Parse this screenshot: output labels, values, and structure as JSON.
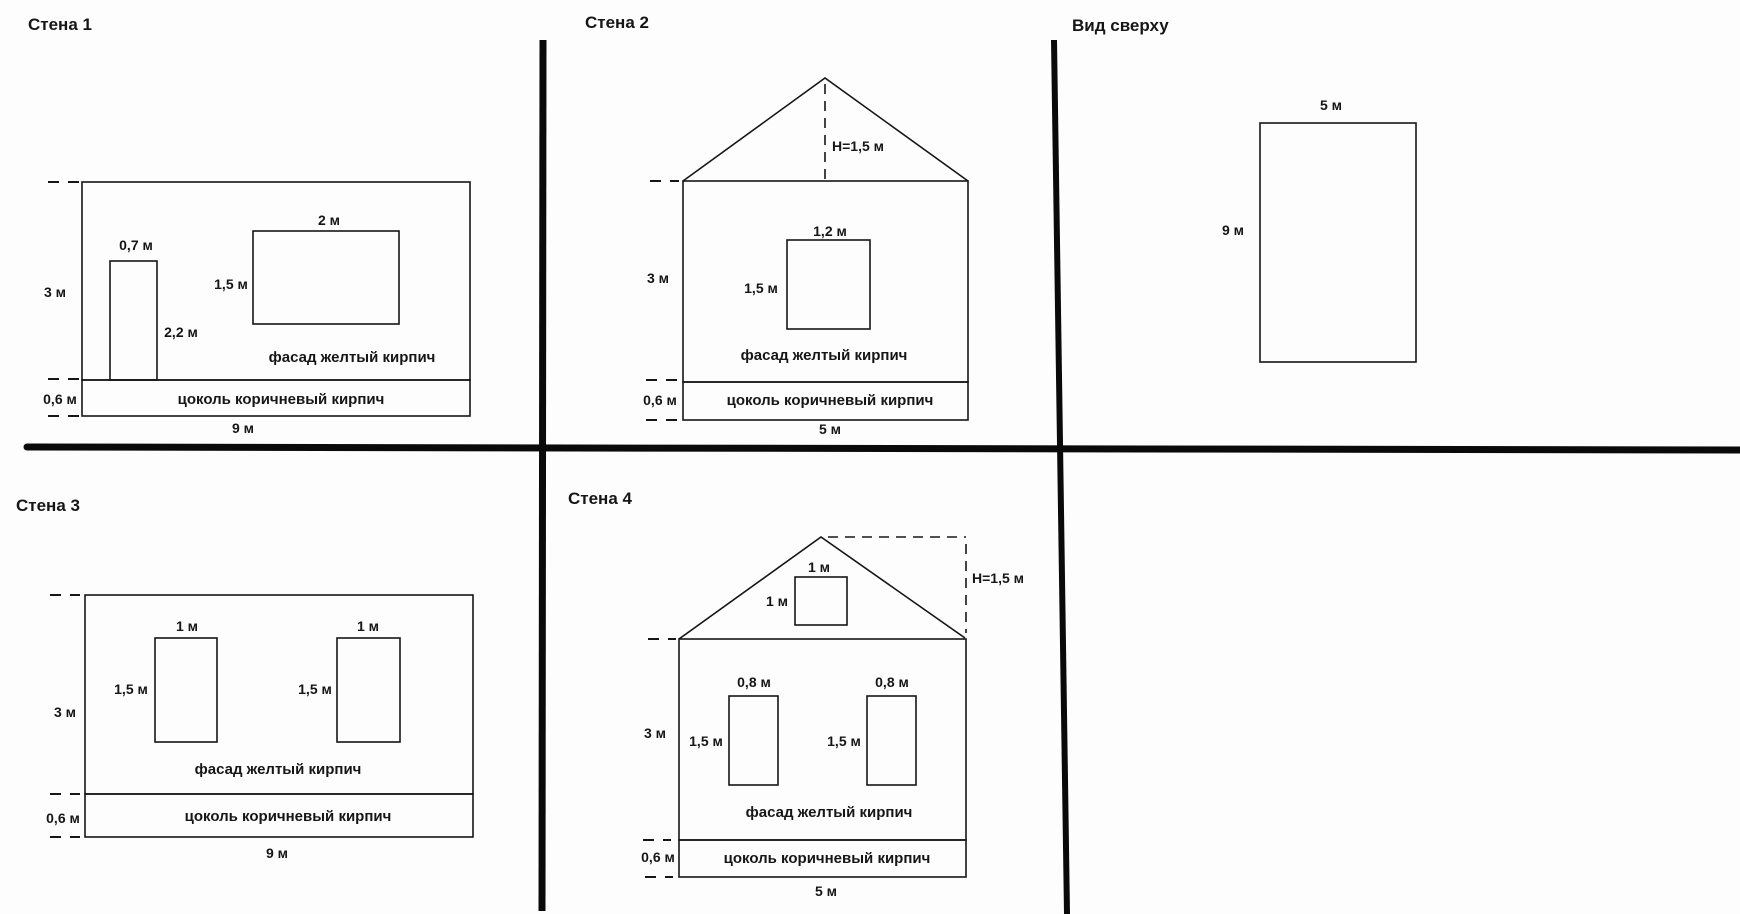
{
  "colors": {
    "line": "#161616",
    "background": "#fdfdfd"
  },
  "panels": {
    "wall1": {
      "title": "Стена 1",
      "wall_height": "3 м",
      "wall_width": "9 м",
      "plinth_height": "0,6 м",
      "facade_material": "фасад желтый кирпич",
      "plinth_material": "цоколь коричневый кирпич",
      "door_width": "0,7 м",
      "door_height": "2,2 м",
      "window_width": "2 м",
      "window_height": "1,5 м"
    },
    "wall2": {
      "title": "Стена 2",
      "roof_height": "H=1,5 м",
      "wall_height": "3 м",
      "wall_width": "5 м",
      "plinth_height": "0,6 м",
      "facade_material": "фасад желтый кирпич",
      "plinth_material": "цоколь коричневый кирпич",
      "window_width": "1,2 м",
      "window_height": "1,5 м"
    },
    "top_view": {
      "title": "Вид сверху",
      "width": "5 м",
      "depth": "9 м"
    },
    "wall3": {
      "title": "Стена 3",
      "wall_height": "3 м",
      "wall_width": "9 м",
      "plinth_height": "0,6 м",
      "facade_material": "фасад желтый кирпич",
      "plinth_material": "цоколь коричневый кирпич",
      "window1_width": "1 м",
      "window1_height": "1,5 м",
      "window2_width": "1 м",
      "window2_height": "1,5 м"
    },
    "wall4": {
      "title": "Стена 4",
      "roof_height": "H=1,5 м",
      "gable_window_width": "1 м",
      "gable_window_height": "1 м",
      "wall_height": "3 м",
      "wall_width": "5 м",
      "plinth_height": "0,6 м",
      "facade_material": "фасад желтый кирпич",
      "plinth_material": "цоколь коричневый кирпич",
      "window1_width": "0,8 м",
      "window1_height": "1,5 м",
      "window2_width": "0,8 м",
      "window2_height": "1,5 м"
    }
  }
}
